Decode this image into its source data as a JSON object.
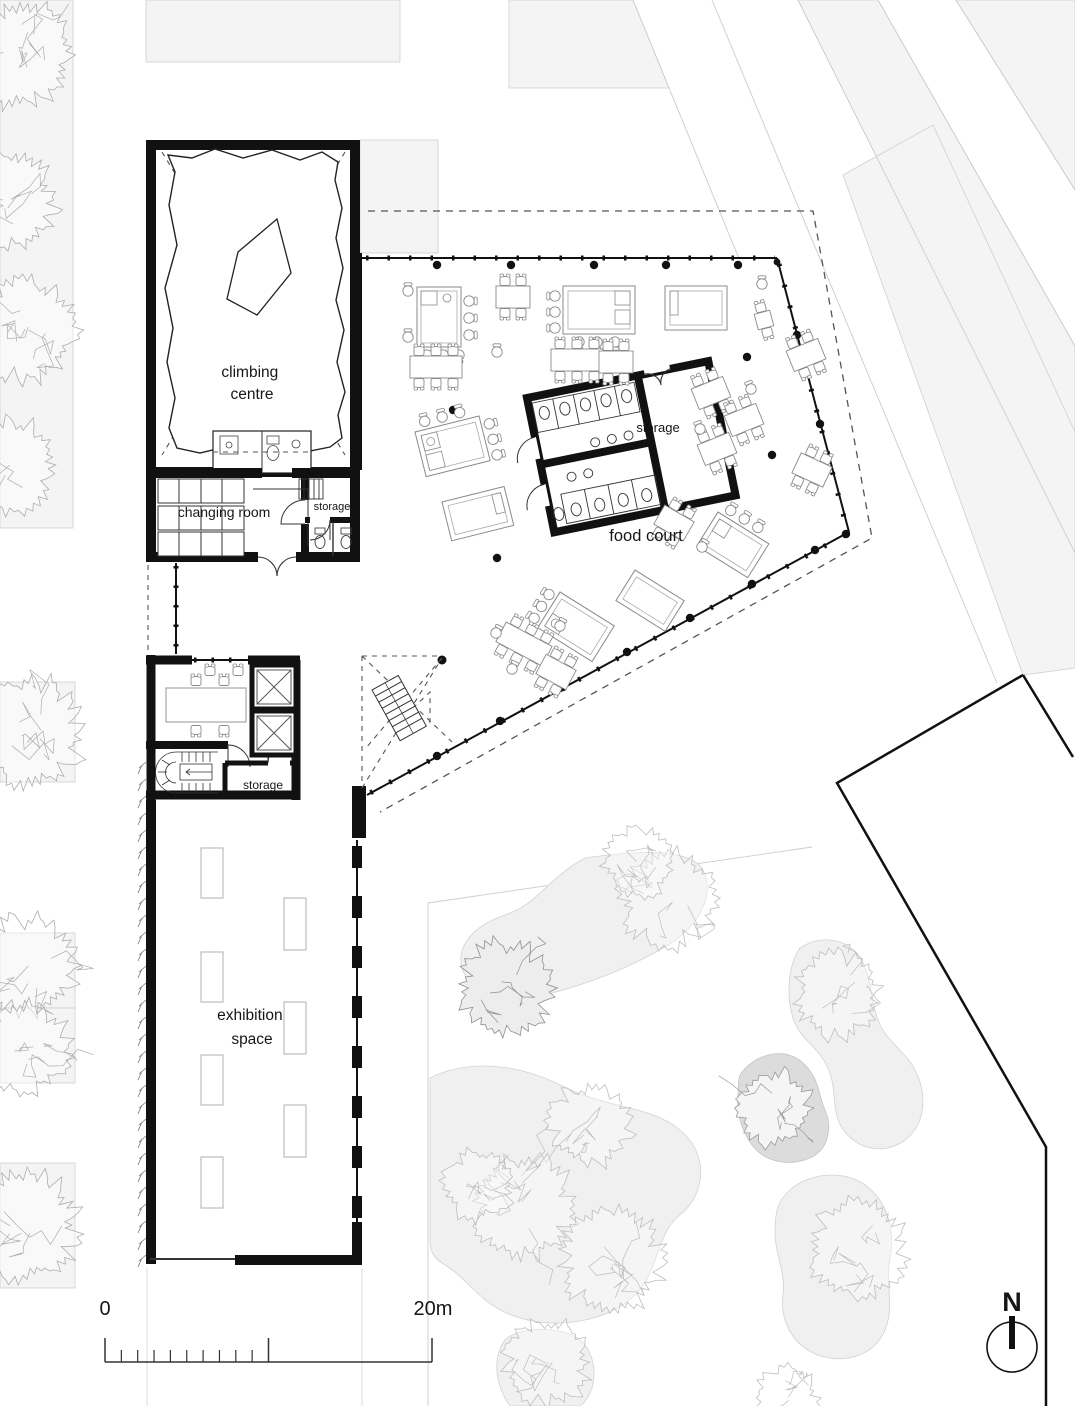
{
  "plan": {
    "rooms": {
      "climbing_centre": {
        "line1": "climbing",
        "line2": "centre"
      },
      "changing_room": "changing room",
      "changing_storage": "storage",
      "food_court": "food court",
      "food_storage": "storage",
      "core_storage": "storage",
      "exhibition": {
        "line1": "exhibition",
        "line2": "space"
      }
    },
    "scale_bar": {
      "start": "0",
      "end": "20m"
    },
    "north_arrow": {
      "label": "N"
    },
    "colors": {
      "wall": "#111111",
      "context_fill": "#f4f4f4",
      "bed_fill": "#f0f0f0",
      "bed_dark": "#dcdcdc",
      "furniture": "#8a8a8a"
    }
  }
}
